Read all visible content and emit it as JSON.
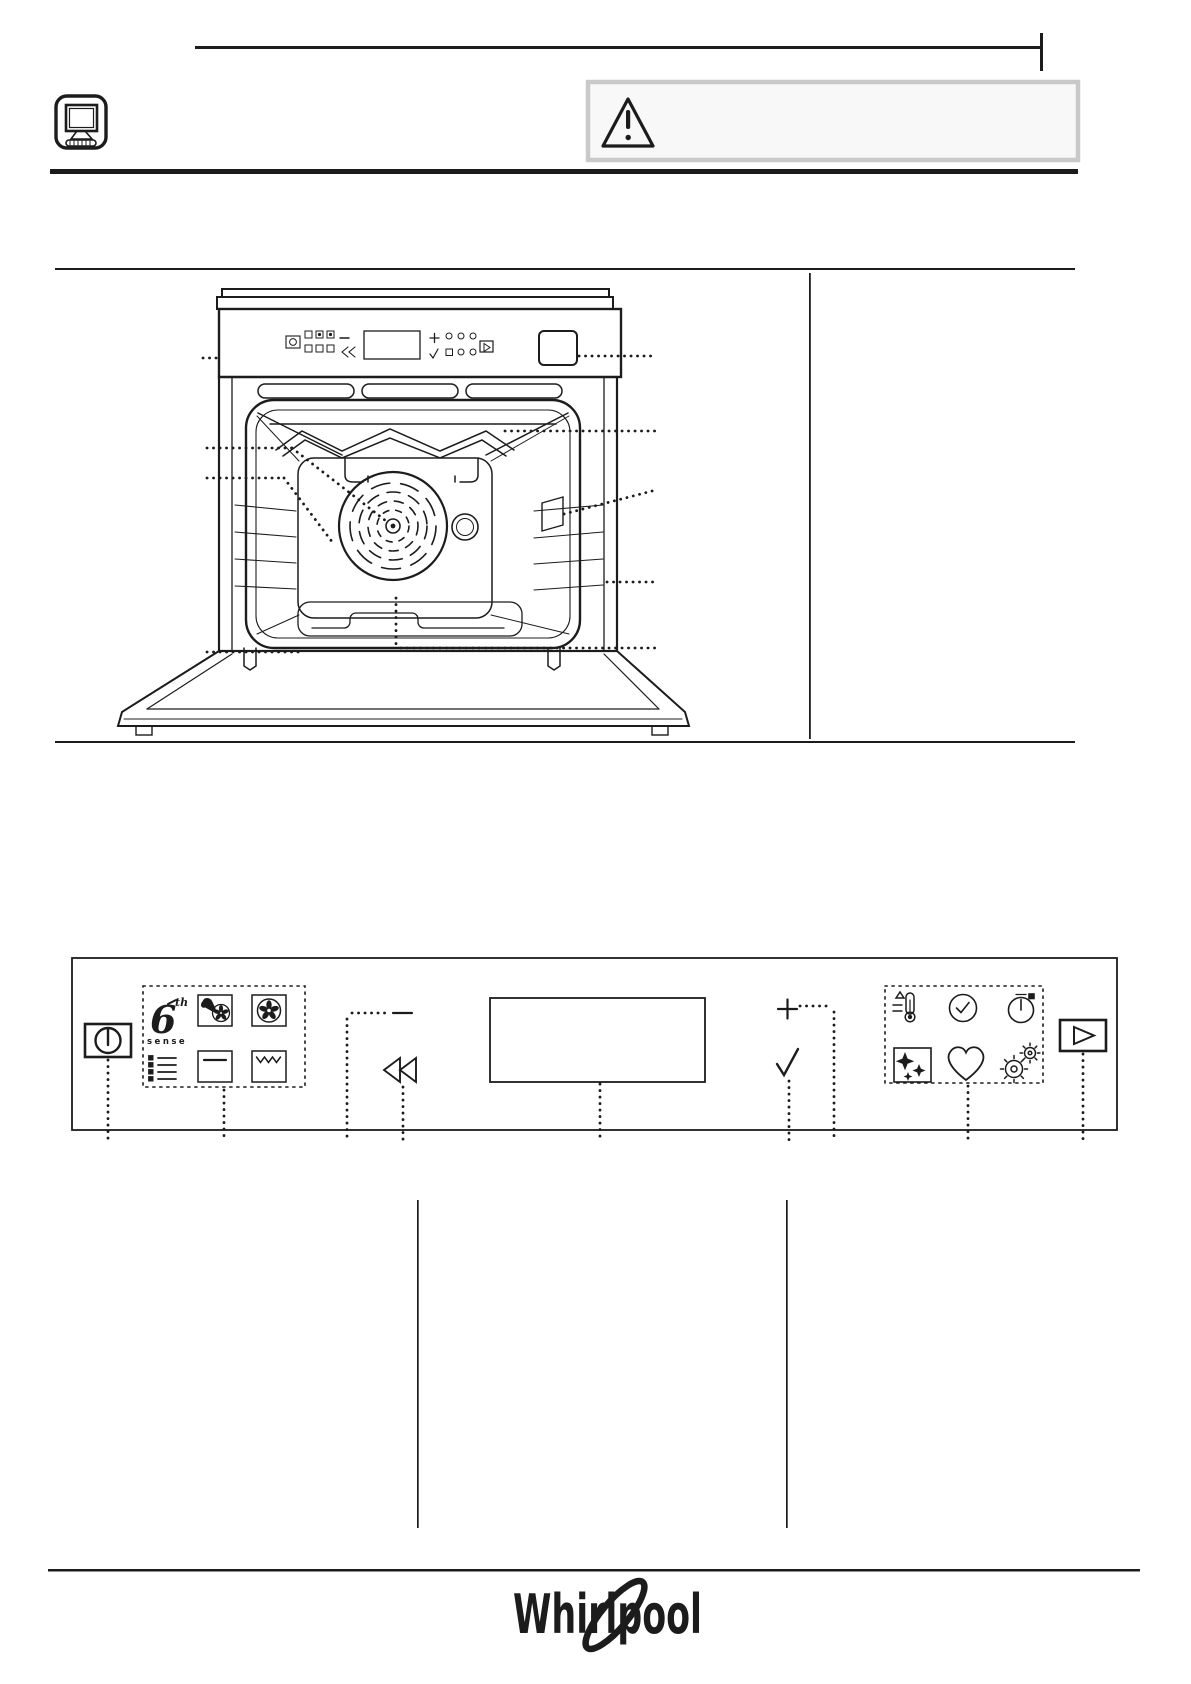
{
  "page": {
    "kind": "appliance user-guide page (line-art, no body text)",
    "background": "#ffffff",
    "ink_color": "#1c1c1c"
  },
  "header": {
    "icons": [
      "monitor-icon",
      "warning-triangle-icon"
    ],
    "warning_box": {
      "border_color": "#c9c9c9",
      "background": "#f8f8f8"
    }
  },
  "oven_diagram": {
    "description": "front view of built-in oven with open door",
    "parts": [
      "control-panel-strip",
      "display-window",
      "grill-heating-element",
      "oven-lamp",
      "fan-with-round-plate",
      "shelf-runners",
      "side-opening",
      "bottom-heating-element",
      "door",
      "identification-plate"
    ],
    "callouts_left": 5,
    "callouts_right": 5
  },
  "control_panel_diagram": {
    "items": [
      {
        "name": "on-off-button",
        "glyph": "power"
      },
      {
        "name": "functions-group",
        "glyphs": [
          "6th-sense",
          "assisted-cooking",
          "fan-cooking",
          "menu-list",
          "conventional",
          "grill"
        ]
      },
      {
        "name": "minus-button",
        "glyph": "−"
      },
      {
        "name": "back-button",
        "glyph": "rewind"
      },
      {
        "name": "display-window",
        "glyph": "rectangle"
      },
      {
        "name": "plus-button",
        "glyph": "+"
      },
      {
        "name": "confirm-button",
        "glyph": "check"
      },
      {
        "name": "options-group",
        "glyphs": [
          "temperature",
          "clock",
          "timer",
          "self-clean",
          "favourites",
          "settings"
        ]
      },
      {
        "name": "start-button",
        "glyph": "play"
      }
    ]
  },
  "branding": {
    "logo_text": "Whirlpool",
    "six_sense": {
      "numeral": "6",
      "superscript": "th",
      "word": "sense"
    }
  }
}
